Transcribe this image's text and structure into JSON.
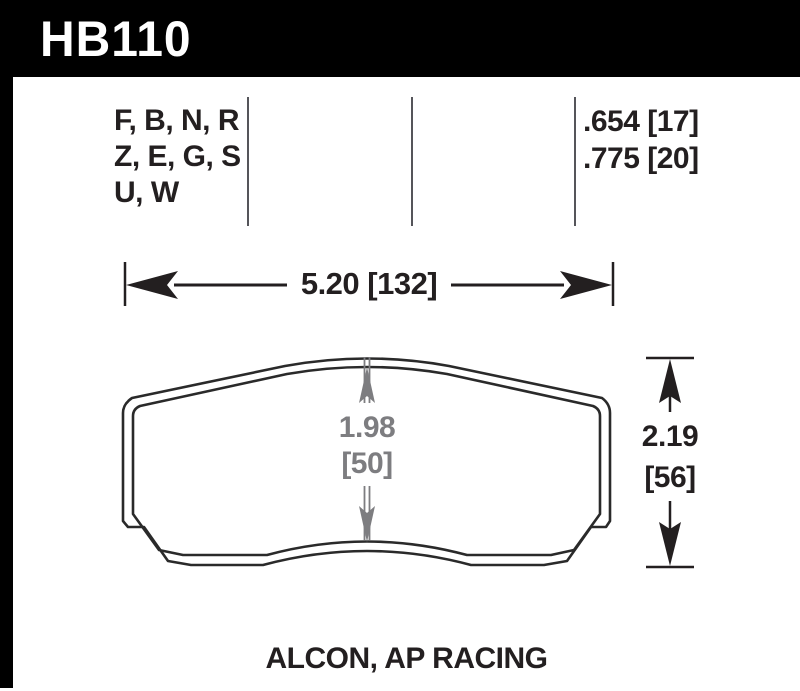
{
  "banner": {
    "part_number": "HB110"
  },
  "spec_table": {
    "compound_rows": [
      "F, B, N, R",
      "Z, E, G, S",
      "U, W"
    ],
    "thickness_values": [
      ".654 [17]",
      ".775 [20]"
    ]
  },
  "dimensions": {
    "overall_width": "5.20 [132]",
    "pad_height_in": "1.98",
    "pad_height_mm": "[50]",
    "overall_height_in": "2.19",
    "overall_height_mm": "[56]"
  },
  "footer": {
    "applications": "ALCON, AP RACING"
  },
  "colors": {
    "banner_bg": "#000000",
    "ink": "#231f20",
    "dimension_gray": "#7d7d80",
    "divider_gray": "#55555a"
  }
}
